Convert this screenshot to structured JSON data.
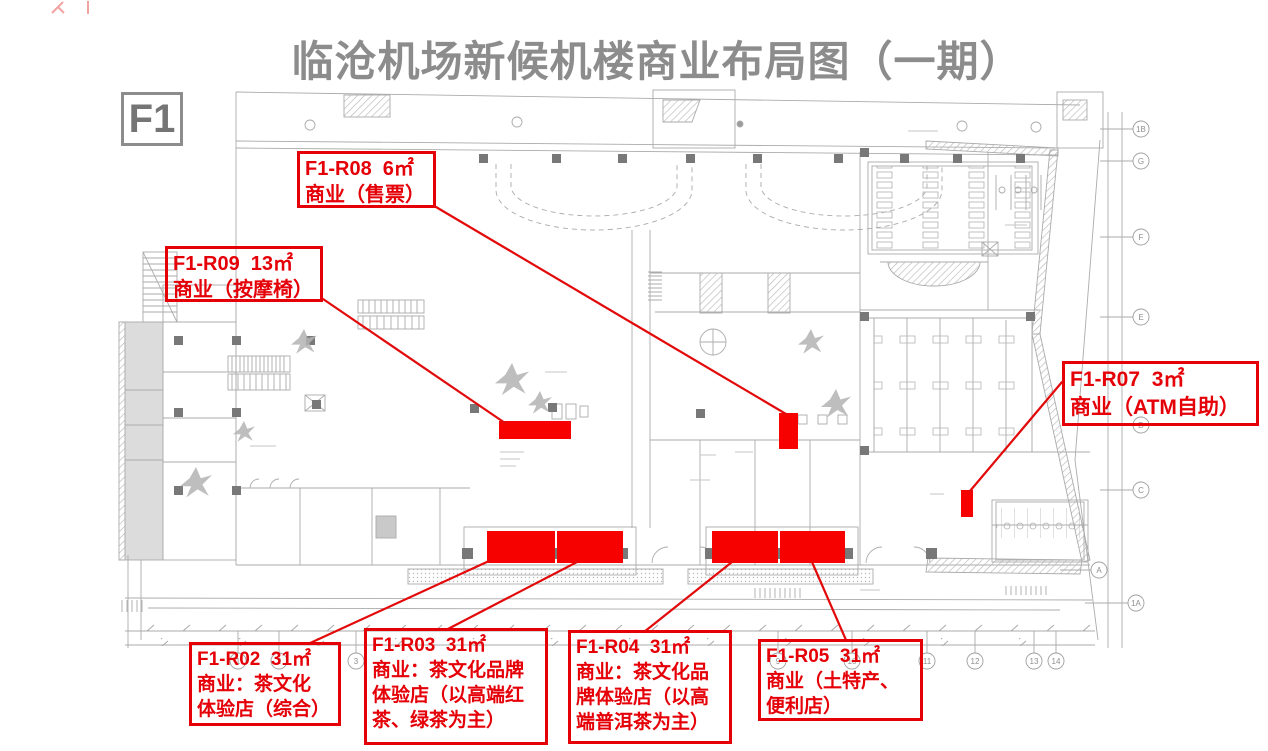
{
  "page": {
    "title": "临沧机场新候机楼商业布局图（一期）",
    "floor_label": "F1"
  },
  "colors": {
    "title_gray": "#8c8c8c",
    "callout_red": "#e50008",
    "highlight_red": "#f60000",
    "plan_line_gray": "#ababab"
  },
  "shops": [
    {
      "id": "F1-R02",
      "area": "31㎡",
      "use": "商业：茶文化体验店（综合）",
      "label_lines": [
        "F1-R02  31㎡",
        "商业：茶文化",
        "体验店（综合）"
      ]
    },
    {
      "id": "F1-R03",
      "area": "31㎡",
      "use": "商业：茶文化品牌体验店（以高端红茶、绿茶为主）",
      "label_lines": [
        "F1-R03  31㎡",
        "商业：茶文化品牌",
        "体验店（以高端红",
        "茶、绿茶为主）"
      ]
    },
    {
      "id": "F1-R04",
      "area": "31㎡",
      "use": "商业：茶文化品牌体验店（以高端普洱茶为主）",
      "label_lines": [
        "F1-R04  31㎡",
        "商业：茶文化品",
        "牌体验店（以高",
        "端普洱茶为主）"
      ]
    },
    {
      "id": "F1-R05",
      "area": "31㎡",
      "use": "商业（土特产、便利店）",
      "label_lines": [
        "F1-R05  31㎡",
        "商业（土特产、",
        "便利店）"
      ]
    },
    {
      "id": "F1-R07",
      "area": "3㎡",
      "use": "商业（ATM自助）",
      "label_lines": [
        "F1-R07  3㎡",
        "商业（ATM自助）"
      ]
    },
    {
      "id": "F1-R08",
      "area": "6㎡",
      "use": "商业（售票）",
      "label_lines": [
        "F1-R08  6㎡",
        "商业（售票）"
      ]
    },
    {
      "id": "F1-R09",
      "area": "13㎡",
      "use": "商业（按摩椅）",
      "label_lines": [
        "F1-R09  13㎡",
        "商业（按摩椅）"
      ]
    }
  ],
  "plan": {
    "right_grid_labels": [
      "1B",
      "G",
      "F",
      "E",
      "D",
      "C",
      "A",
      "1A"
    ],
    "bottom_grid_labels": [
      "1",
      "2",
      "3",
      "9",
      "10",
      "11",
      "12",
      "13",
      "14"
    ]
  }
}
